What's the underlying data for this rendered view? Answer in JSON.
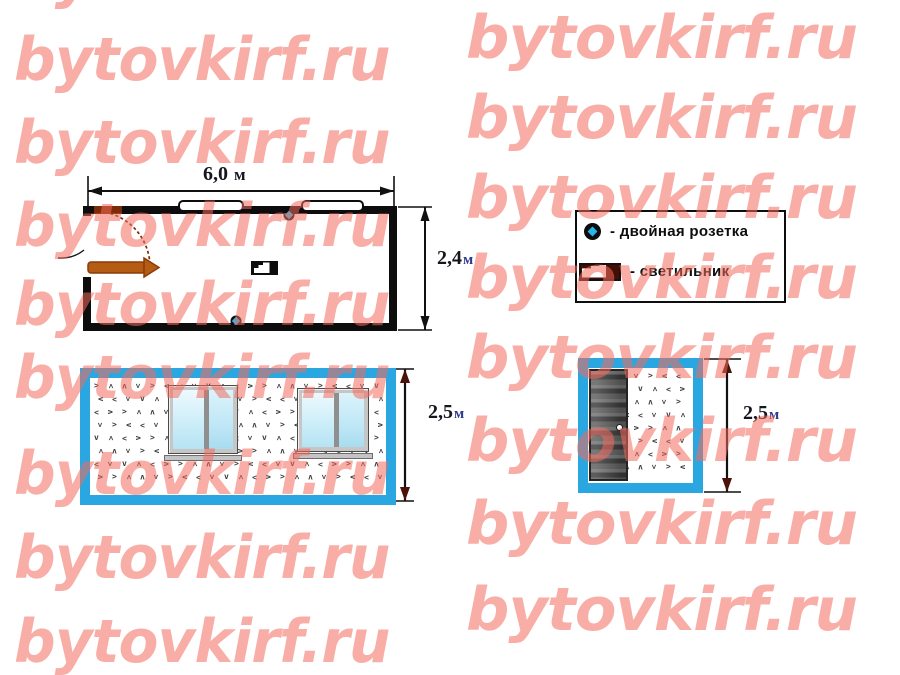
{
  "watermark": {
    "text": "bytovkirf.ru",
    "color": "#f26c5d",
    "opacity": 0.55
  },
  "colors": {
    "frame_blue": "#2aa7e0",
    "socket_cyan": "#2ab5ea",
    "door_leaf_brown": "#b45c14",
    "dimension_unit_blue": "#2b3a8c"
  },
  "floor_plan": {
    "width_dim": {
      "value": "6,0",
      "unit": "м"
    },
    "height_dim": {
      "value": "2,4",
      "unit": "м"
    }
  },
  "legend": {
    "items": [
      {
        "icon": "double-socket-icon",
        "label": "- двойная розетка"
      },
      {
        "icon": "ceiling-light-icon",
        "label": "- светильник"
      }
    ]
  },
  "front_elevation": {
    "height_dim": {
      "value": "2,5",
      "unit": "м"
    }
  },
  "end_elevation": {
    "height_dim": {
      "value": "2,5",
      "unit": "м"
    }
  }
}
